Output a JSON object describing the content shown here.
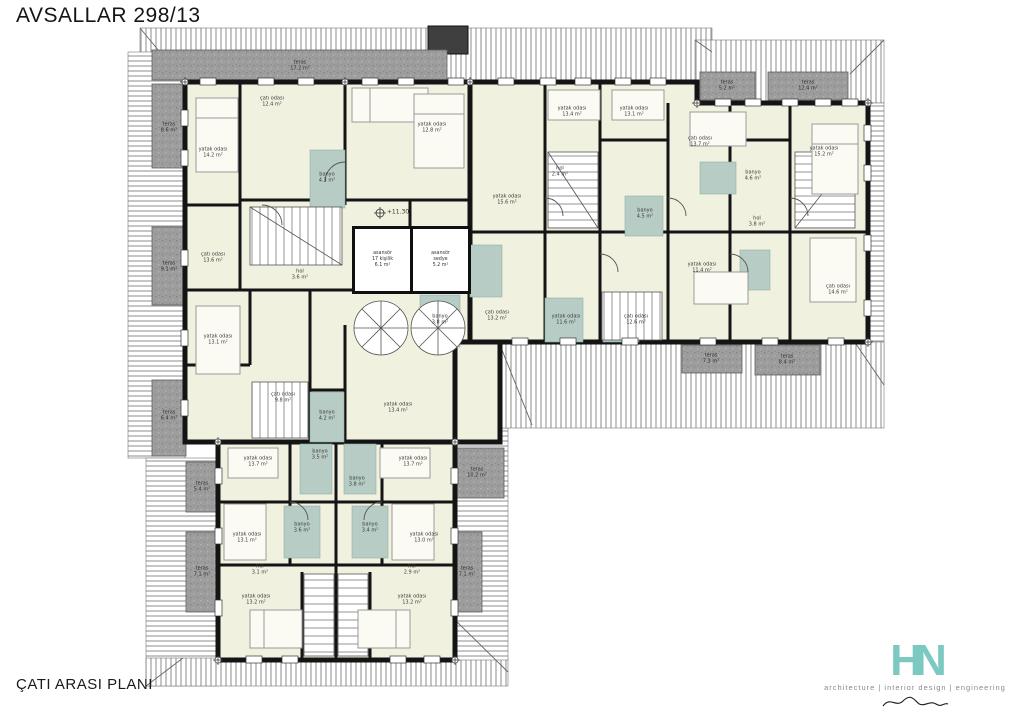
{
  "title": "AVSALLAR 298/13",
  "caption": "ÇATI ARASI PLANI",
  "logo": {
    "monogram": "HN",
    "tagline": "architecture | interior design | engineering",
    "brand_color": "#7cc9c1"
  },
  "plan": {
    "colors": {
      "wall": "#141414",
      "room_fill": "#f1f1df",
      "bath_fill": "#b6ccc5",
      "terrace_fill": "#9d9d9d",
      "roof_line": "#666666"
    },
    "elevators": {
      "left": {
        "l1": "asansör",
        "l2": "17 kişilik",
        "l3": "6.1 m²"
      },
      "right": {
        "l1": "asansör",
        "l2": "sedye",
        "l3": "5.2 m²"
      }
    },
    "labels": [
      {
        "t": "yatak odası",
        "a": "14.2 m²",
        "x": 213,
        "y": 153,
        "k": "room"
      },
      {
        "t": "çatı odası",
        "a": "12.4 m²",
        "x": 272,
        "y": 102,
        "k": "room"
      },
      {
        "t": "yatak odası",
        "a": "12.8 m²",
        "x": 432,
        "y": 128,
        "k": "room"
      },
      {
        "t": "banyo",
        "a": "4.3 m²",
        "x": 327,
        "y": 178,
        "k": "bath"
      },
      {
        "t": "çatı odası",
        "a": "13.6 m²",
        "x": 213,
        "y": 258,
        "k": "room"
      },
      {
        "t": "hol",
        "a": "3.6 m²",
        "x": 300,
        "y": 275,
        "k": "hall"
      },
      {
        "t": "yatak odası",
        "a": "13.1 m²",
        "x": 218,
        "y": 340,
        "k": "room"
      },
      {
        "t": "banyo",
        "a": "3.8 m²",
        "x": 440,
        "y": 320,
        "k": "bath"
      },
      {
        "t": "çatı odası",
        "a": "9.8 m²",
        "x": 283,
        "y": 398,
        "k": "room"
      },
      {
        "t": "banyo",
        "a": "4.2 m²",
        "x": 327,
        "y": 416,
        "k": "bath"
      },
      {
        "t": "yatak odası",
        "a": "13.4 m²",
        "x": 398,
        "y": 408,
        "k": "room"
      },
      {
        "t": "çatı odası",
        "a": "13.2 m²",
        "x": 497,
        "y": 316,
        "k": "room"
      },
      {
        "t": "yatak odası",
        "a": "15.6 m²",
        "x": 507,
        "y": 200,
        "k": "room"
      },
      {
        "t": "yatak odası",
        "a": "13.4 m²",
        "x": 572,
        "y": 112,
        "k": "room"
      },
      {
        "t": "yatak odası",
        "a": "13.1 m²",
        "x": 634,
        "y": 112,
        "k": "room"
      },
      {
        "t": "hol",
        "a": "2.4 m²",
        "x": 560,
        "y": 172,
        "k": "hall"
      },
      {
        "t": "banyo",
        "a": "4.5 m²",
        "x": 645,
        "y": 214,
        "k": "bath"
      },
      {
        "t": "yatak odası",
        "a": "11.6 m²",
        "x": 566,
        "y": 320,
        "k": "room"
      },
      {
        "t": "çatı odası",
        "a": "12.6 m²",
        "x": 636,
        "y": 320,
        "k": "room"
      },
      {
        "t": "çatı odası",
        "a": "13.7 m²",
        "x": 700,
        "y": 142,
        "k": "room"
      },
      {
        "t": "banyo",
        "a": "4.6 m²",
        "x": 753,
        "y": 176,
        "k": "bath"
      },
      {
        "t": "hol",
        "a": "3.8 m²",
        "x": 757,
        "y": 222,
        "k": "hall"
      },
      {
        "t": "yatak odası",
        "a": "11.4 m²",
        "x": 702,
        "y": 268,
        "k": "room"
      },
      {
        "t": "yatak odası",
        "a": "15.2 m²",
        "x": 824,
        "y": 152,
        "k": "room"
      },
      {
        "t": "çatı odası",
        "a": "14.6 m²",
        "x": 838,
        "y": 290,
        "k": "room"
      },
      {
        "t": "yatak odası",
        "a": "13.7 m²",
        "x": 258,
        "y": 462,
        "k": "room"
      },
      {
        "t": "yatak odası",
        "a": "13.7 m²",
        "x": 413,
        "y": 462,
        "k": "room"
      },
      {
        "t": "banyo",
        "a": "3.5 m²",
        "x": 320,
        "y": 455,
        "k": "bath"
      },
      {
        "t": "banyo",
        "a": "3.8 m²",
        "x": 357,
        "y": 482,
        "k": "bath"
      },
      {
        "t": "yatak odası",
        "a": "13.1 m²",
        "x": 247,
        "y": 538,
        "k": "room"
      },
      {
        "t": "yatak odası",
        "a": "13.0 m²",
        "x": 424,
        "y": 538,
        "k": "room"
      },
      {
        "t": "banyo",
        "a": "3.6 m²",
        "x": 302,
        "y": 528,
        "k": "bath"
      },
      {
        "t": "banyo",
        "a": "3.4 m²",
        "x": 370,
        "y": 528,
        "k": "bath"
      },
      {
        "t": "hol",
        "a": "3.1 m²",
        "x": 260,
        "y": 570,
        "k": "hall"
      },
      {
        "t": "hol",
        "a": "2.9 m²",
        "x": 412,
        "y": 570,
        "k": "hall"
      },
      {
        "t": "yatak odası",
        "a": "13.2 m²",
        "x": 256,
        "y": 600,
        "k": "room"
      },
      {
        "t": "yatak odası",
        "a": "13.2 m²",
        "x": 412,
        "y": 600,
        "k": "room"
      },
      {
        "t": "teras",
        "a": "17.2 m²",
        "x": 300,
        "y": 66,
        "k": "terrace"
      },
      {
        "t": "teras",
        "a": "8.6 m²",
        "x": 169,
        "y": 128,
        "k": "terrace"
      },
      {
        "t": "teras",
        "a": "9.1 m²",
        "x": 169,
        "y": 267,
        "k": "terrace"
      },
      {
        "t": "teras",
        "a": "6.4 m²",
        "x": 169,
        "y": 416,
        "k": "terrace"
      },
      {
        "t": "teras",
        "a": "5.2 m²",
        "x": 727,
        "y": 86,
        "k": "terrace"
      },
      {
        "t": "teras",
        "a": "12.4 m²",
        "x": 808,
        "y": 86,
        "k": "terrace"
      },
      {
        "t": "teras",
        "a": "7.3 m²",
        "x": 711,
        "y": 359,
        "k": "terrace"
      },
      {
        "t": "teras",
        "a": "8.4 m²",
        "x": 787,
        "y": 360,
        "k": "terrace"
      },
      {
        "t": "teras",
        "a": "10.2 m²",
        "x": 477,
        "y": 473,
        "k": "terrace"
      },
      {
        "t": "teras",
        "a": "7.1 m²",
        "x": 467,
        "y": 572,
        "k": "terrace"
      },
      {
        "t": "teras",
        "a": "5.4 m²",
        "x": 202,
        "y": 487,
        "k": "terrace"
      },
      {
        "t": "teras",
        "a": "7.1 m²",
        "x": 202,
        "y": 572,
        "k": "terrace"
      },
      {
        "t": "+11.30",
        "a": "",
        "x": 398,
        "y": 213,
        "k": "level"
      }
    ]
  }
}
